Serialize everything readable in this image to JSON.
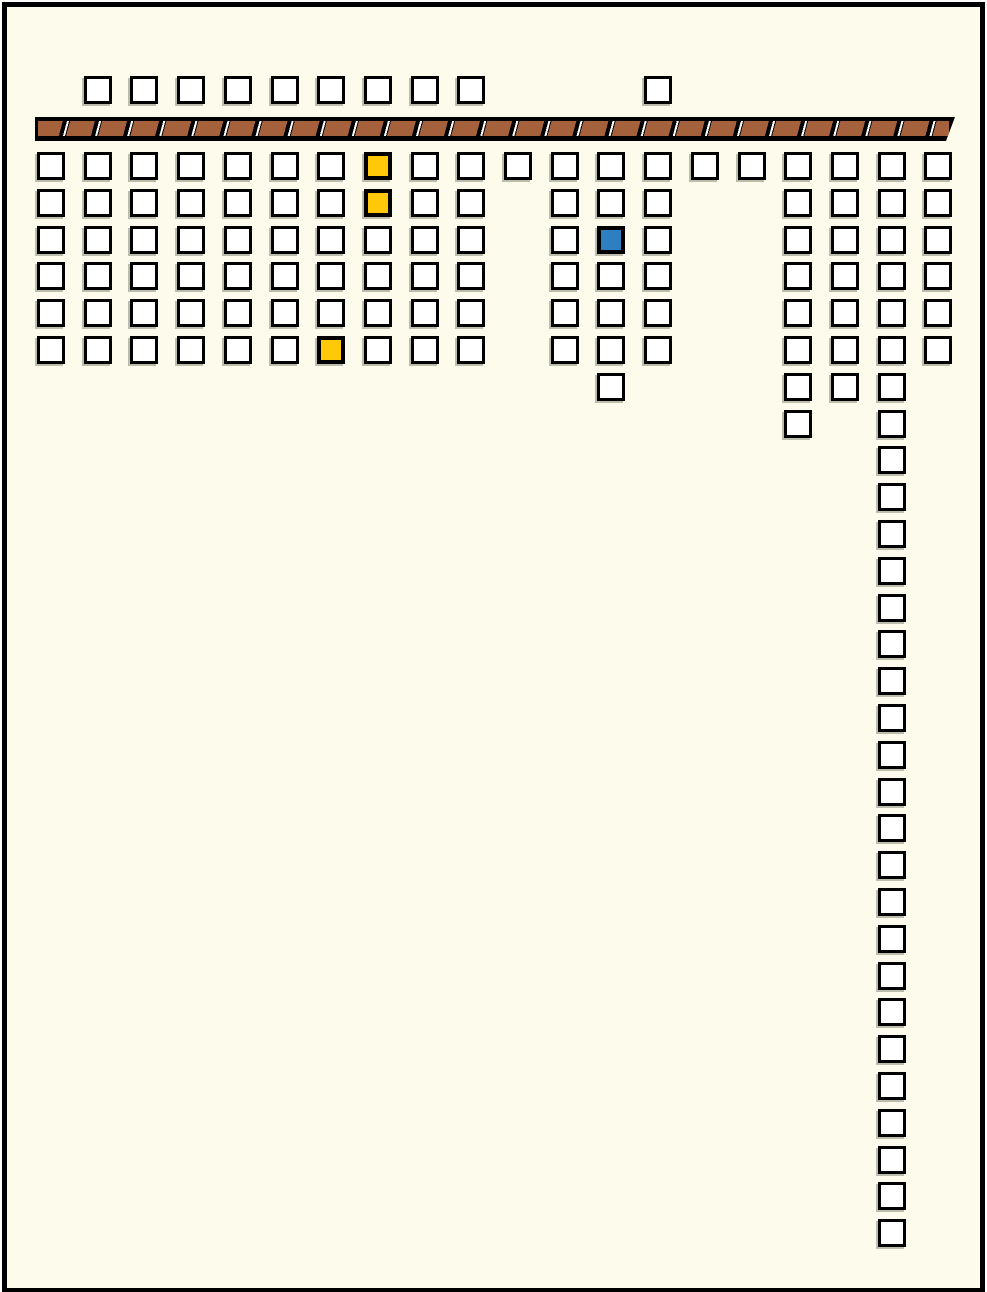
{
  "diagram": {
    "description": "plot-map grid of selectable squares with hatched wall bar",
    "colors": {
      "background": "#FDFCEC",
      "outline": "#000000",
      "empty": "#FFFFFF",
      "yellow": "#FFC808",
      "blue": "#2E7FC2",
      "wall": "#A5613C"
    },
    "wall": {
      "x": 35,
      "y": 117,
      "width": 920,
      "height": 24,
      "hatch_segments": 28
    },
    "grid": {
      "origin_x": 37,
      "col_pitch": 46.7,
      "top_row_y": 76,
      "first_row_y": 152,
      "row_pitch": 36.8,
      "cell_size": 28,
      "columns": 20,
      "rows_total": 31
    },
    "rows": [
      {
        "row": 0,
        "cols": [
          1,
          2,
          3,
          4,
          5,
          6,
          7,
          8,
          9,
          13
        ]
      },
      {
        "row": 1,
        "cols": [
          0,
          1,
          2,
          3,
          4,
          5,
          6,
          7,
          8,
          9,
          10,
          11,
          12,
          13,
          14,
          15,
          16,
          17,
          18,
          19
        ]
      },
      {
        "row": 2,
        "cols": [
          0,
          1,
          2,
          3,
          4,
          5,
          6,
          7,
          8,
          9,
          11,
          12,
          13,
          16,
          17,
          18,
          19
        ]
      },
      {
        "row": 3,
        "cols": [
          0,
          1,
          2,
          3,
          4,
          5,
          6,
          7,
          8,
          9,
          11,
          12,
          13,
          16,
          17,
          18,
          19
        ]
      },
      {
        "row": 4,
        "cols": [
          0,
          1,
          2,
          3,
          4,
          5,
          6,
          7,
          8,
          9,
          11,
          12,
          13,
          16,
          17,
          18,
          19
        ]
      },
      {
        "row": 5,
        "cols": [
          0,
          1,
          2,
          3,
          4,
          5,
          6,
          7,
          8,
          9,
          11,
          12,
          13,
          16,
          17,
          18,
          19
        ]
      },
      {
        "row": 6,
        "cols": [
          0,
          1,
          2,
          3,
          4,
          5,
          6,
          7,
          8,
          9,
          11,
          12,
          13,
          16,
          17,
          18,
          19
        ]
      },
      {
        "row": 7,
        "cols": [
          12,
          16,
          17,
          18
        ]
      },
      {
        "row": 8,
        "cols": [
          16,
          18
        ]
      },
      {
        "row": 9,
        "cols": [
          18
        ]
      },
      {
        "row": 10,
        "cols": [
          18
        ]
      },
      {
        "row": 11,
        "cols": [
          18
        ]
      },
      {
        "row": 12,
        "cols": [
          18
        ]
      },
      {
        "row": 13,
        "cols": [
          18
        ]
      },
      {
        "row": 14,
        "cols": [
          18
        ]
      },
      {
        "row": 15,
        "cols": [
          18
        ]
      },
      {
        "row": 16,
        "cols": [
          18
        ]
      },
      {
        "row": 17,
        "cols": [
          18
        ]
      },
      {
        "row": 18,
        "cols": [
          18
        ]
      },
      {
        "row": 19,
        "cols": [
          18
        ]
      },
      {
        "row": 20,
        "cols": [
          18
        ]
      },
      {
        "row": 21,
        "cols": [
          18
        ]
      },
      {
        "row": 22,
        "cols": [
          18
        ]
      },
      {
        "row": 23,
        "cols": [
          18
        ]
      },
      {
        "row": 24,
        "cols": [
          18
        ]
      },
      {
        "row": 25,
        "cols": [
          18
        ]
      },
      {
        "row": 26,
        "cols": [
          18
        ]
      },
      {
        "row": 27,
        "cols": [
          18
        ]
      },
      {
        "row": 28,
        "cols": [
          18
        ]
      },
      {
        "row": 29,
        "cols": [
          18
        ]
      },
      {
        "row": 30,
        "cols": [
          18
        ]
      }
    ],
    "highlights": [
      {
        "col": 7,
        "row": 1,
        "state": "yellow"
      },
      {
        "col": 7,
        "row": 2,
        "state": "yellow"
      },
      {
        "col": 12,
        "row": 3,
        "state": "blue"
      },
      {
        "col": 6,
        "row": 6,
        "state": "yellow"
      }
    ]
  }
}
